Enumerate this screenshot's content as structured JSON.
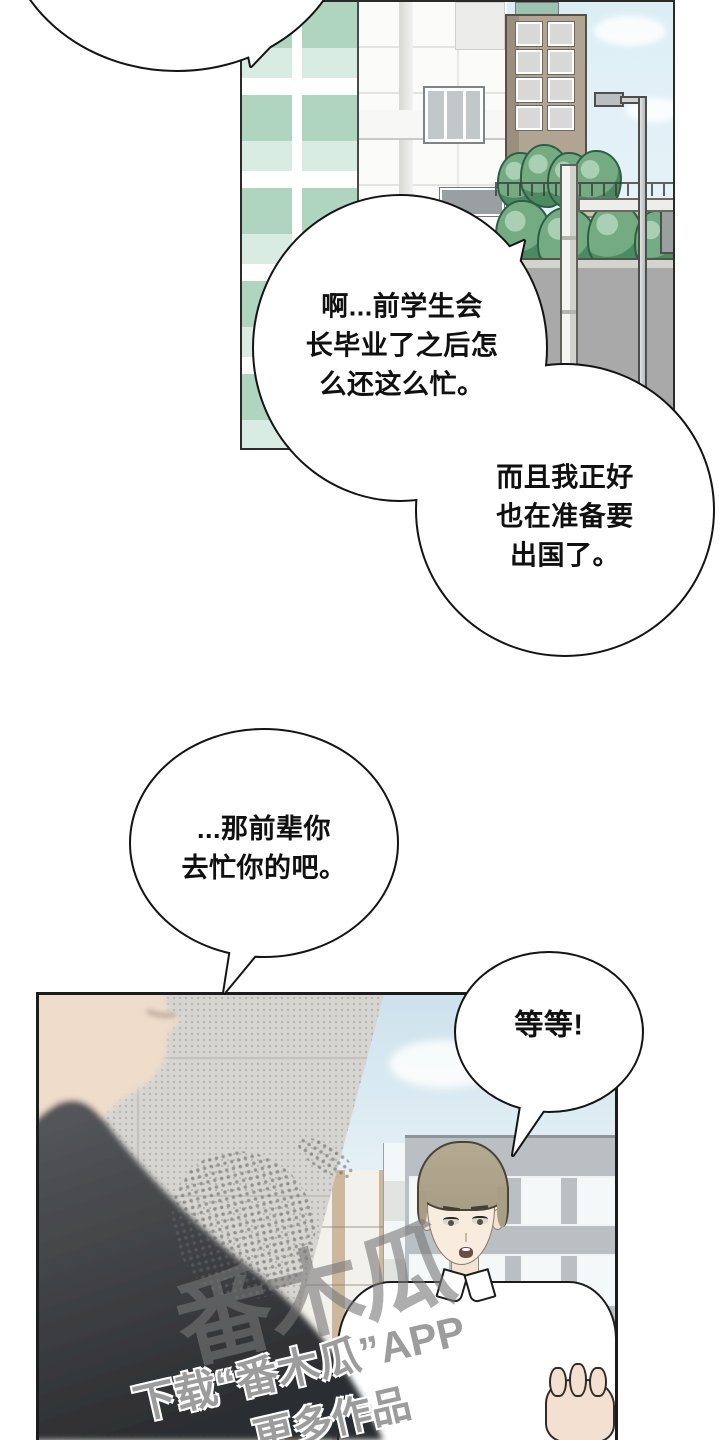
{
  "page": {
    "width": 719,
    "height": 1440,
    "background": "#ffffff"
  },
  "speech": {
    "ah": "啊...前学生会\n长毕业了之后怎\n么还这么忙。",
    "erqie": "而且我正好\n也在准备要\n出国了。",
    "qianbei": "...那前辈你\n去忙你的吧。",
    "wait": "等等!"
  },
  "watermark": {
    "logo": "番木瓜",
    "line1": "下载“番木瓜”APP",
    "line2": "更多作品"
  },
  "colors": {
    "ink": "#141414",
    "panel_border": "#1c1c1c",
    "sky_panel1": "#dceef5",
    "mint_glass": "#afd5c0",
    "tan_building": "#b2a493",
    "tree_green": "#74ab82",
    "road": "#a9a9a9",
    "concrete_wall": "#d6d5d1",
    "sky_panel2": "#cde2ed",
    "gray_building": "#b9bfc2",
    "hair": "#a89e86",
    "skin": "#f8ecdf",
    "blurred_skin": "#efdccb",
    "dark_clothing": "#3a3b3e",
    "shirt": "#ffffff",
    "watermark_gray": "#9c9c9c"
  }
}
